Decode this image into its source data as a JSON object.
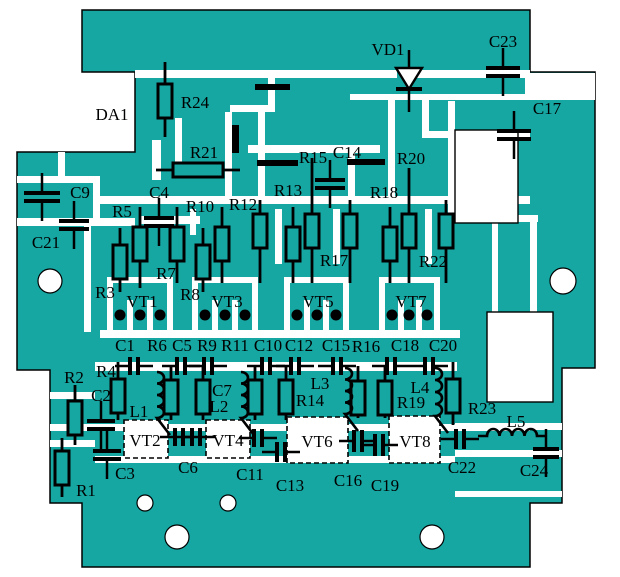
{
  "meta": {
    "title": "PCB component placement diagram",
    "width": 620,
    "height": 577
  },
  "colors": {
    "copper": "#16A7A2",
    "trace": "#FFFFFF",
    "ink": "#000000",
    "page": "#FFFFFF"
  },
  "board": {
    "outline": [
      [
        82,
        10
      ],
      [
        530,
        10
      ],
      [
        530,
        72
      ],
      [
        595,
        72
      ],
      [
        595,
        368
      ],
      [
        562,
        368
      ],
      [
        562,
        503
      ],
      [
        530,
        503
      ],
      [
        530,
        567
      ],
      [
        82,
        567
      ],
      [
        82,
        503
      ],
      [
        50,
        503
      ],
      [
        50,
        370
      ],
      [
        17,
        370
      ],
      [
        17,
        152
      ],
      [
        135,
        152
      ],
      [
        135,
        72
      ],
      [
        82,
        72
      ]
    ],
    "white_zones": [
      [
        525,
        73,
        70,
        27
      ]
    ],
    "cutouts": [
      [
        455,
        130,
        63,
        93
      ],
      [
        487,
        312,
        66,
        90
      ]
    ],
    "transistor_boxes": [
      {
        "label": "VT2",
        "x": 124,
        "y": 420,
        "w": 44,
        "h": 38
      },
      {
        "label": "VT4",
        "x": 206,
        "y": 420,
        "w": 44,
        "h": 38
      },
      {
        "label": "VT6",
        "x": 287,
        "y": 417,
        "w": 61,
        "h": 46
      },
      {
        "label": "VT8",
        "x": 389,
        "y": 416,
        "w": 51,
        "h": 47
      }
    ],
    "holes": [
      [
        50,
        281,
        12
      ],
      [
        563,
        281,
        13
      ],
      [
        145,
        503,
        8
      ],
      [
        228,
        503,
        8
      ],
      [
        177,
        537,
        12
      ],
      [
        432,
        537,
        12
      ]
    ],
    "traces": [
      [
        135,
        70,
        262,
        8
      ],
      [
        415,
        70,
        115,
        8
      ],
      [
        350,
        94,
        75,
        6
      ],
      [
        422,
        94,
        108,
        6
      ],
      [
        422,
        100,
        7,
        38
      ],
      [
        422,
        131,
        108,
        7
      ],
      [
        268,
        78,
        7,
        30
      ],
      [
        230,
        105,
        45,
        7
      ],
      [
        225,
        112,
        7,
        90
      ],
      [
        258,
        108,
        7,
        94
      ],
      [
        248,
        145,
        132,
        8
      ],
      [
        348,
        153,
        7,
        50
      ],
      [
        388,
        100,
        7,
        103
      ],
      [
        448,
        101,
        7,
        114
      ],
      [
        95,
        196,
        435,
        8
      ],
      [
        140,
        216,
        60,
        8
      ],
      [
        17,
        176,
        76,
        7
      ],
      [
        58,
        152,
        7,
        26
      ],
      [
        93,
        176,
        7,
        44
      ],
      [
        17,
        218,
        118,
        8
      ],
      [
        84,
        226,
        7,
        106
      ],
      [
        175,
        118,
        7,
        45
      ],
      [
        152,
        140,
        9,
        40
      ],
      [
        190,
        209,
        6,
        26
      ],
      [
        275,
        209,
        7,
        55
      ],
      [
        333,
        209,
        7,
        55
      ],
      [
        425,
        209,
        7,
        55
      ],
      [
        460,
        215,
        78,
        7
      ],
      [
        492,
        222,
        6,
        90
      ],
      [
        530,
        222,
        7,
        90
      ],
      [
        100,
        330,
        360,
        8
      ],
      [
        95,
        362,
        362,
        9
      ],
      [
        50,
        392,
        45,
        7
      ],
      [
        50,
        440,
        45,
        7
      ],
      [
        50,
        424,
        480,
        7
      ],
      [
        95,
        456,
        360,
        7
      ],
      [
        455,
        423,
        107,
        7
      ],
      [
        455,
        450,
        107,
        7
      ],
      [
        455,
        491,
        107,
        6
      ],
      [
        107,
        283,
        6,
        47
      ],
      [
        167,
        283,
        6,
        47
      ],
      [
        127,
        300,
        6,
        30
      ],
      [
        147,
        300,
        6,
        30
      ],
      [
        107,
        277,
        66,
        6
      ],
      [
        192,
        283,
        6,
        47
      ],
      [
        252,
        283,
        6,
        47
      ],
      [
        212,
        300,
        6,
        30
      ],
      [
        232,
        300,
        6,
        30
      ],
      [
        192,
        277,
        66,
        6
      ],
      [
        284,
        283,
        6,
        47
      ],
      [
        343,
        283,
        6,
        47
      ],
      [
        304,
        300,
        6,
        30
      ],
      [
        323,
        300,
        6,
        30
      ],
      [
        284,
        277,
        65,
        6
      ],
      [
        379,
        283,
        6,
        47
      ],
      [
        434,
        283,
        6,
        47
      ],
      [
        398,
        300,
        6,
        30
      ],
      [
        416,
        300,
        6,
        30
      ],
      [
        379,
        277,
        61,
        6
      ]
    ]
  },
  "symbols": {
    "resistors_v": [
      {
        "x": 165,
        "y": 101,
        "lu": 62,
        "ld": 137
      },
      {
        "x": 120,
        "y": 262,
        "lu": 228,
        "ld": 292
      },
      {
        "x": 140,
        "y": 244,
        "lu": 207,
        "ld": 288
      },
      {
        "x": 177,
        "y": 244,
        "lu": 207,
        "ld": 283
      },
      {
        "x": 203,
        "y": 262,
        "lu": 228,
        "ld": 292
      },
      {
        "x": 222,
        "y": 244,
        "lu": 207,
        "ld": 283
      },
      {
        "x": 260,
        "y": 231,
        "lu": 200,
        "ld": 283
      },
      {
        "x": 293,
        "y": 244,
        "lu": 207,
        "ld": 283
      },
      {
        "x": 312,
        "y": 231,
        "lu": 158,
        "ld": 283
      },
      {
        "x": 350,
        "y": 231,
        "lu": 200,
        "ld": 283
      },
      {
        "x": 390,
        "y": 244,
        "lu": 207,
        "ld": 283
      },
      {
        "x": 409,
        "y": 231,
        "lu": 168,
        "ld": 283
      },
      {
        "x": 446,
        "y": 231,
        "lu": 200,
        "ld": 283
      },
      {
        "x": 118,
        "y": 396,
        "lu": 362,
        "ld": 420
      },
      {
        "x": 75,
        "y": 418,
        "lu": 385,
        "ld": 445
      },
      {
        "x": 62,
        "y": 468,
        "lu": 438,
        "ld": 497
      },
      {
        "x": 171,
        "y": 397,
        "lu": 366,
        "ld": 420
      },
      {
        "x": 203,
        "y": 397,
        "lu": 366,
        "ld": 420
      },
      {
        "x": 255,
        "y": 397,
        "lu": 366,
        "ld": 420
      },
      {
        "x": 286,
        "y": 397,
        "lu": 366,
        "ld": 420
      },
      {
        "x": 358,
        "y": 398,
        "lu": 366,
        "ld": 418
      },
      {
        "x": 385,
        "y": 398,
        "lu": 366,
        "ld": 418
      },
      {
        "x": 453,
        "y": 396,
        "lu": 362,
        "ld": 425
      }
    ],
    "resistors_h": [
      {
        "x": 198,
        "y": 170,
        "ll": 156,
        "lr": 240
      }
    ],
    "capacitors_v": [
      {
        "x": 42,
        "y": 197,
        "w": 36
      },
      {
        "x": 74,
        "y": 225,
        "w": 30
      },
      {
        "x": 159,
        "y": 222,
        "w": 30
      },
      {
        "x": 330,
        "y": 184,
        "w": 30
      },
      {
        "x": 503,
        "y": 72,
        "w": 34
      },
      {
        "x": 514,
        "y": 135,
        "w": 34
      },
      {
        "x": 101,
        "y": 425,
        "w": 28
      },
      {
        "x": 107,
        "y": 455,
        "w": 28
      },
      {
        "x": 546,
        "y": 453,
        "w": 26
      }
    ],
    "capacitors_h": [
      {
        "x": 134,
        "y": 366,
        "h": 18
      },
      {
        "x": 181,
        "y": 366,
        "h": 18
      },
      {
        "x": 208,
        "y": 366,
        "h": 18
      },
      {
        "x": 266,
        "y": 366,
        "h": 18
      },
      {
        "x": 295,
        "y": 366,
        "h": 18
      },
      {
        "x": 337,
        "y": 366,
        "h": 18
      },
      {
        "x": 391,
        "y": 366,
        "h": 18
      },
      {
        "x": 429,
        "y": 366,
        "h": 18
      },
      {
        "x": 179,
        "y": 437,
        "h": 18
      },
      {
        "x": 196,
        "y": 437,
        "h": 18
      },
      {
        "x": 258,
        "y": 438,
        "h": 18
      },
      {
        "x": 281,
        "y": 452,
        "h": 20
      },
      {
        "x": 358,
        "y": 441,
        "h": 22
      },
      {
        "x": 379,
        "y": 445,
        "h": 22
      },
      {
        "x": 460,
        "y": 439,
        "h": 20
      }
    ],
    "bars": [
      [
        255,
        84,
        35,
        6
      ],
      [
        232,
        125,
        7,
        28
      ],
      [
        257,
        160,
        41,
        6
      ],
      [
        347,
        159,
        38,
        6
      ]
    ],
    "coils_v": [
      {
        "x": 157,
        "y1": 372,
        "y2": 418
      },
      {
        "x": 241,
        "y1": 372,
        "y2": 418
      },
      {
        "x": 345,
        "y1": 368,
        "y2": 414
      },
      {
        "x": 435,
        "y1": 368,
        "y2": 416
      }
    ],
    "coil_h": {
      "x1": 487,
      "x2": 537,
      "y": 436
    },
    "pads": [
      [
        120,
        315
      ],
      [
        140,
        315
      ],
      [
        160,
        315
      ],
      [
        205,
        315
      ],
      [
        225,
        315
      ],
      [
        245,
        315
      ],
      [
        297,
        315
      ],
      [
        317,
        315
      ],
      [
        336,
        315
      ],
      [
        392,
        315
      ],
      [
        409,
        315
      ],
      [
        427,
        315
      ]
    ],
    "diode": {
      "x": 409,
      "y1": 50,
      "y2": 112,
      "tw": 26,
      "ty1": 68,
      "ty2": 89
    }
  },
  "labels": [
    {
      "text": "DA1",
      "x": 112,
      "y": 114
    },
    {
      "text": "R24",
      "x": 195,
      "y": 102
    },
    {
      "text": "VD1",
      "x": 388,
      "y": 49
    },
    {
      "text": "C23",
      "x": 503,
      "y": 41
    },
    {
      "text": "C17",
      "x": 547,
      "y": 108
    },
    {
      "text": "R21",
      "x": 204,
      "y": 152
    },
    {
      "text": "R15",
      "x": 313,
      "y": 157
    },
    {
      "text": "C14",
      "x": 347,
      "y": 152
    },
    {
      "text": "R20",
      "x": 411,
      "y": 158
    },
    {
      "text": "R13",
      "x": 288,
      "y": 190
    },
    {
      "text": "R18",
      "x": 384,
      "y": 192
    },
    {
      "text": "C9",
      "x": 80,
      "y": 192
    },
    {
      "text": "C4",
      "x": 159,
      "y": 192
    },
    {
      "text": "R5",
      "x": 122,
      "y": 211
    },
    {
      "text": "R10",
      "x": 200,
      "y": 206
    },
    {
      "text": "R12",
      "x": 243,
      "y": 204
    },
    {
      "text": "C21",
      "x": 46,
      "y": 242
    },
    {
      "text": "R3",
      "x": 105,
      "y": 292
    },
    {
      "text": "R7",
      "x": 166,
      "y": 273
    },
    {
      "text": "R8",
      "x": 190,
      "y": 294
    },
    {
      "text": "R17",
      "x": 334,
      "y": 260
    },
    {
      "text": "R22",
      "x": 433,
      "y": 261
    },
    {
      "text": "VT1",
      "x": 142,
      "y": 301
    },
    {
      "text": "VT3",
      "x": 227,
      "y": 301
    },
    {
      "text": "VT5",
      "x": 318,
      "y": 301
    },
    {
      "text": "VT7",
      "x": 411,
      "y": 301
    },
    {
      "text": "C1",
      "x": 125,
      "y": 345
    },
    {
      "text": "R6",
      "x": 157,
      "y": 345
    },
    {
      "text": "C5",
      "x": 182,
      "y": 345
    },
    {
      "text": "R9",
      "x": 207,
      "y": 345
    },
    {
      "text": "R11",
      "x": 235,
      "y": 345
    },
    {
      "text": "C10",
      "x": 268,
      "y": 345
    },
    {
      "text": "C12",
      "x": 299,
      "y": 345
    },
    {
      "text": "C15",
      "x": 336,
      "y": 345
    },
    {
      "text": "R16",
      "x": 366,
      "y": 346
    },
    {
      "text": "C18",
      "x": 405,
      "y": 345
    },
    {
      "text": "C20",
      "x": 443,
      "y": 345
    },
    {
      "text": "R2",
      "x": 74,
      "y": 377
    },
    {
      "text": "R4",
      "x": 106,
      "y": 371
    },
    {
      "text": "C2",
      "x": 101,
      "y": 395
    },
    {
      "text": "L1",
      "x": 139,
      "y": 411
    },
    {
      "text": "C7",
      "x": 222,
      "y": 390
    },
    {
      "text": "L2",
      "x": 219,
      "y": 406
    },
    {
      "text": "L3",
      "x": 320,
      "y": 383
    },
    {
      "text": "R14",
      "x": 310,
      "y": 400
    },
    {
      "text": "L4",
      "x": 420,
      "y": 387
    },
    {
      "text": "R19",
      "x": 411,
      "y": 402
    },
    {
      "text": "R23",
      "x": 482,
      "y": 408
    },
    {
      "text": "L5",
      "x": 516,
      "y": 421
    },
    {
      "text": "VT2",
      "x": 145,
      "y": 440
    },
    {
      "text": "VT4",
      "x": 228,
      "y": 440
    },
    {
      "text": "VT6",
      "x": 317,
      "y": 441
    },
    {
      "text": "VT8",
      "x": 415,
      "y": 441
    },
    {
      "text": "C3",
      "x": 125,
      "y": 473
    },
    {
      "text": "C6",
      "x": 188,
      "y": 467
    },
    {
      "text": "C11",
      "x": 250,
      "y": 474
    },
    {
      "text": "C13",
      "x": 290,
      "y": 485
    },
    {
      "text": "C16",
      "x": 348,
      "y": 480
    },
    {
      "text": "C19",
      "x": 385,
      "y": 485
    },
    {
      "text": "C22",
      "x": 462,
      "y": 467
    },
    {
      "text": "C24",
      "x": 534,
      "y": 470
    },
    {
      "text": "R1",
      "x": 86,
      "y": 490
    }
  ]
}
